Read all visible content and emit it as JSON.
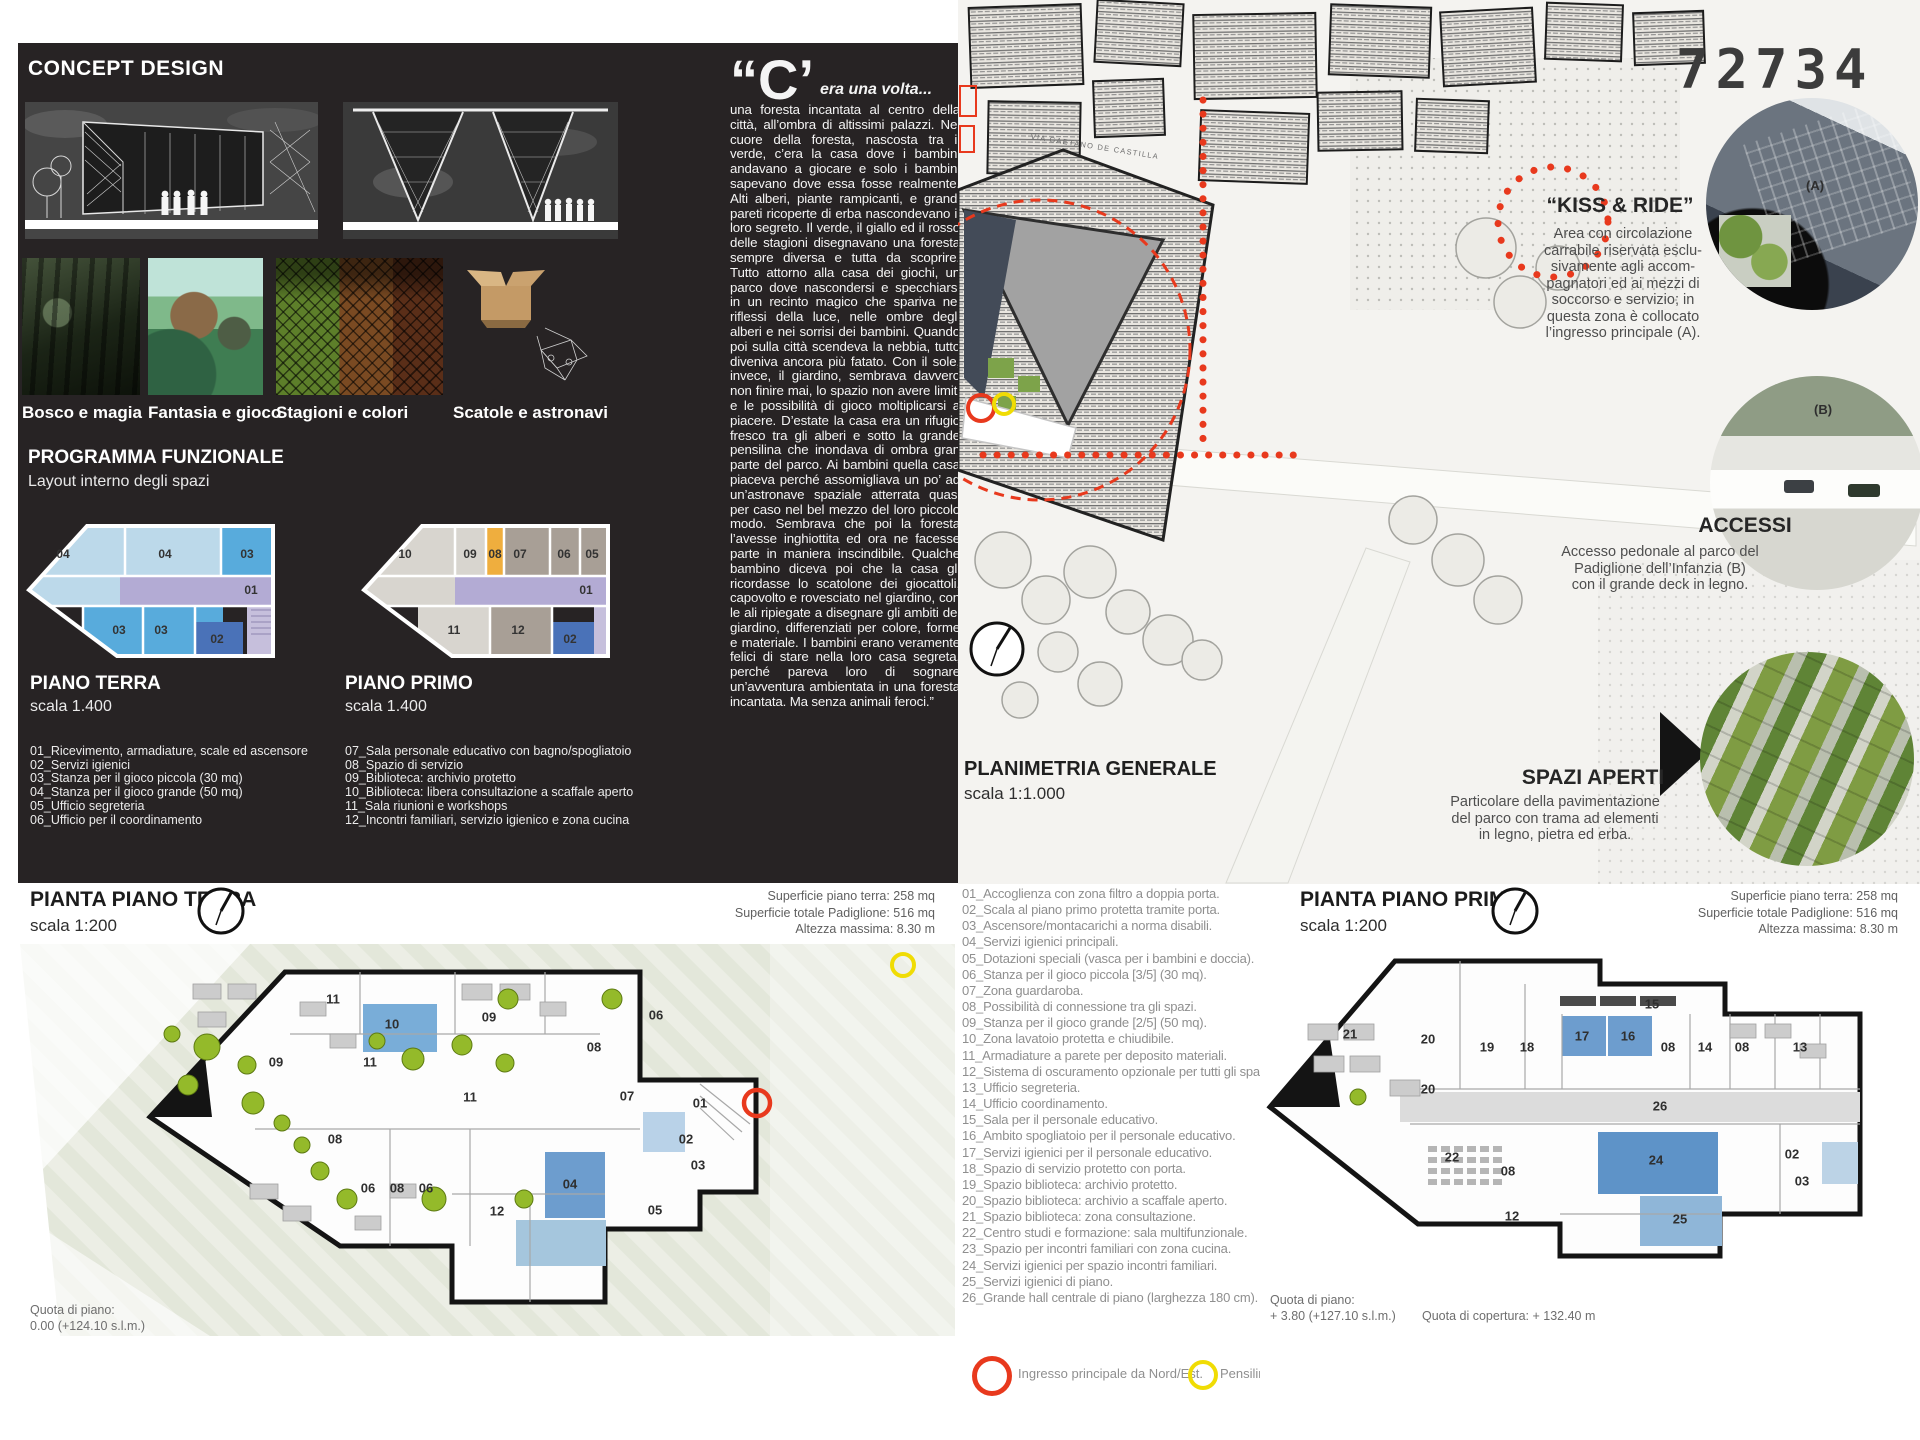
{
  "board_number": "72734",
  "colors": {
    "panel_black": "#272324",
    "accent_red": "#e8391d",
    "accent_yellow": "#f0dc04",
    "tree_green": "#94ba2a",
    "room_blue": "#58abdc",
    "room_dark_blue": "#4a72b8",
    "room_lavender": "#b3abd4",
    "room_orange": "#efae3e"
  },
  "concept": {
    "title": "CONCEPT DESIGN",
    "thumbs": [
      {
        "label": "Bosco e magia"
      },
      {
        "label": "Fantasia e gioco"
      },
      {
        "label": "Stagioni e colori"
      },
      {
        "label": "Scatole e astronavi"
      }
    ],
    "programma_title": "PROGRAMMA FUNZIONALE",
    "programma_subtitle": "Layout interno degli spazi",
    "piano_terra": {
      "title": "PIANO TERRA",
      "scale": "scala 1.400",
      "items": [
        "01_Ricevimento, armadiature, scale ed ascensore",
        "02_Servizi igienici",
        "03_Stanza per il gioco piccola (30 mq)",
        "04_Stanza per il gioco grande (50 mq)",
        "05_Ufficio segreteria",
        "06_Ufficio per il coordinamento"
      ]
    },
    "piano_primo": {
      "title": "PIANO PRIMO",
      "scale": "scala 1.400",
      "items": [
        "07_Sala personale educativo con bagno/spogliatoio",
        "08_Spazio di servizio",
        "09_Biblioteca: archivio protetto",
        "10_Biblioteca: libera consultazione a scaffale aperto",
        "11_Sala riunioni e workshops",
        "12_Incontri familiari, servizio igienico e zona cucina"
      ]
    },
    "mini_terra_rooms": [
      {
        "n": "04",
        "x": 38,
        "y": 36
      },
      {
        "n": "04",
        "x": 140,
        "y": 36
      },
      {
        "n": "03",
        "x": 222,
        "y": 36
      },
      {
        "n": "01",
        "x": 226,
        "y": 72
      },
      {
        "n": "03",
        "x": 94,
        "y": 112
      },
      {
        "n": "03",
        "x": 136,
        "y": 112
      },
      {
        "n": "02",
        "x": 192,
        "y": 121
      }
    ],
    "mini_primo_rooms": [
      {
        "n": "10",
        "x": 45,
        "y": 36
      },
      {
        "n": "09",
        "x": 110,
        "y": 36
      },
      {
        "n": "08",
        "x": 135,
        "y": 36
      },
      {
        "n": "07",
        "x": 160,
        "y": 36
      },
      {
        "n": "06",
        "x": 204,
        "y": 36
      },
      {
        "n": "05",
        "x": 232,
        "y": 36
      },
      {
        "n": "01",
        "x": 226,
        "y": 72
      },
      {
        "n": "11",
        "x": 94,
        "y": 112
      },
      {
        "n": "12",
        "x": 158,
        "y": 112
      },
      {
        "n": "02",
        "x": 210,
        "y": 121
      }
    ]
  },
  "story": {
    "dropcap": "“C’",
    "lead": "era una volta...",
    "body": "una foresta incantata al centro della città, all’ombra di altissimi palazzi. Nel cuore della foresta, nascosta tra il verde, c’era la casa dove i bambini andavano a giocare e solo i bambini sapevano dove essa fosse realmente. Alti alberi, piante rampicanti, e grandi pareti ricoperte di erba nascondevano il loro segreto.  Il verde, il giallo ed il rosso delle stagioni disegnavano una foresta sempre diversa e tutta da scoprire. Tutto attorno alla casa dei giochi, un parco dove nascondersi e specchiarsi in un recinto magico che spariva nei riflessi della luce, nelle ombre degli alberi e nei sorrisi dei bambini. Quando poi sulla città scendeva la nebbia, tutto diveniva ancora più fatato. Con il sole, invece, il giardino, sembrava davvero non finire mai, lo spazio non avere limiti e le possibilità di gioco moltiplicarsi a piacere. D’estate la casa era un rifugio fresco tra gli alberi e sotto la grande pensilina che inondava di ombra gran parte del parco. Ai bambini quella casa piaceva perché assomigliava un po’ ad un’astronave spaziale atterrata quasi per caso nel bel mezzo del loro piccolo modo. Sembrava che poi la foresta l’avesse inghiottita ed ora ne facesse parte in maniera inscindibile. Qualche bambino diceva poi che la casa gli ricordasse lo scatolone dei giocattoli, capovolto e rovesciato nel giardino, con le ali ripiegate a disegnare gli ambiti del giardino, differenziati per colore, forme e materiale. I bambini erano veramente felici di stare nella loro casa segreta, perché pareva loro di sognare un’avventura ambientata in una foresta incantata. Ma senza animali feroci.”"
  },
  "siteplan": {
    "title": "PLANIMETRIA GENERALE",
    "scale": "scala 1:1.000",
    "street_label": "VIA GAETANO DE CASTILLA",
    "label_a": "(A)",
    "label_b": "(B)",
    "kiss_ride": {
      "title": "“KISS & RIDE”",
      "lines": [
        "Area con circolazione",
        "carrabile riservata esclu-",
        "sivamente agli accom-",
        "pagnatori ed ai mezzi di",
        "soccorso e servizio; in",
        "questa zona è collocato",
        "l’ingresso principale (A)."
      ]
    },
    "accessi": {
      "title": "ACCESSI",
      "lines": [
        "Accesso pedonale al parco del",
        "Padiglione dell’Infanzia (B)",
        "con il grande deck in legno."
      ]
    },
    "spazi_aperti": {
      "title": "SPAZI  APERTI",
      "lines": [
        "Particolare della pavimentazione",
        "del parco con trama ad  elementi",
        "in legno, pietra ed erba."
      ]
    }
  },
  "ground_floor": {
    "title": "PIANTA PIANO TERRA",
    "scale": "scala 1:200",
    "stats": [
      "Superficie piano terra: 258 mq",
      "Superficie totale Padiglione: 516 mq",
      "Altezza massima: 8.30 m"
    ],
    "quota_label": "Quota di piano:",
    "quota_value": "0.00 (+124.10 s.l.m.)",
    "rooms": [
      {
        "n": "11",
        "x": 333,
        "y": 115
      },
      {
        "n": "10",
        "x": 392,
        "y": 140
      },
      {
        "n": "09",
        "x": 489,
        "y": 133
      },
      {
        "n": "06",
        "x": 656,
        "y": 131
      },
      {
        "n": "08",
        "x": 594,
        "y": 163
      },
      {
        "n": "09",
        "x": 276,
        "y": 178
      },
      {
        "n": "11",
        "x": 370,
        "y": 178
      },
      {
        "n": "11",
        "x": 470,
        "y": 213
      },
      {
        "n": "07",
        "x": 627,
        "y": 212
      },
      {
        "n": "01",
        "x": 700,
        "y": 219
      },
      {
        "n": "08",
        "x": 335,
        "y": 255
      },
      {
        "n": "02",
        "x": 686,
        "y": 255
      },
      {
        "n": "03",
        "x": 698,
        "y": 281
      },
      {
        "n": "06",
        "x": 368,
        "y": 304
      },
      {
        "n": "08",
        "x": 397,
        "y": 304
      },
      {
        "n": "06",
        "x": 426,
        "y": 304
      },
      {
        "n": "04",
        "x": 570,
        "y": 300
      },
      {
        "n": "12",
        "x": 497,
        "y": 327
      },
      {
        "n": "05",
        "x": 655,
        "y": 326
      }
    ]
  },
  "first_floor": {
    "title": "PIANTA PIANO PRIMO",
    "scale": "scala 1:200",
    "stats": [
      "Superficie piano terra: 258 mq",
      "Superficie totale Padiglione: 516 mq",
      "Altezza massima: 8.30 m"
    ],
    "quota_label": "Quota di piano:",
    "quota_value": "+ 3.80 (+127.10 s.l.m.)",
    "quota_copertura": "Quota di copertura: + 132.40 m",
    "rooms": [
      {
        "n": "15",
        "x": 392,
        "y": 120
      },
      {
        "n": "21",
        "x": 90,
        "y": 150
      },
      {
        "n": "20",
        "x": 168,
        "y": 155
      },
      {
        "n": "19",
        "x": 227,
        "y": 163
      },
      {
        "n": "18",
        "x": 267,
        "y": 163
      },
      {
        "n": "17",
        "x": 322,
        "y": 152
      },
      {
        "n": "16",
        "x": 368,
        "y": 152
      },
      {
        "n": "08",
        "x": 408,
        "y": 163
      },
      {
        "n": "14",
        "x": 445,
        "y": 163
      },
      {
        "n": "08",
        "x": 482,
        "y": 163
      },
      {
        "n": "13",
        "x": 540,
        "y": 163
      },
      {
        "n": "20",
        "x": 168,
        "y": 205
      },
      {
        "n": "26",
        "x": 400,
        "y": 222
      },
      {
        "n": "22",
        "x": 192,
        "y": 273
      },
      {
        "n": "08",
        "x": 248,
        "y": 287
      },
      {
        "n": "24",
        "x": 396,
        "y": 276
      },
      {
        "n": "02",
        "x": 532,
        "y": 270
      },
      {
        "n": "03",
        "x": 542,
        "y": 297
      },
      {
        "n": "25",
        "x": 420,
        "y": 335
      },
      {
        "n": "12",
        "x": 252,
        "y": 332
      }
    ]
  },
  "legend": {
    "items": [
      "01_Accoglienza con zona filtro a doppia porta.",
      "02_Scala al piano primo protetta tramite porta.",
      "03_Ascensore/montacarichi a norma disabili.",
      "04_Servizi igienici principali.",
      "05_Dotazioni speciali (vasca per i bambini e doccia).",
      "06_Stanza per il gioco piccola [3/5] (30 mq).",
      "07_Zona guardaroba.",
      "08_Possibilità di connessione tra gli spazi.",
      "09_Stanza per il gioco grande [2/5] (50 mq).",
      "10_Zona lavatoio protetta e chiudibile.",
      "11_Armadiature a parete per deposito materiali.",
      "12_Sistema di oscuramento opzionale per tutti gli spazi",
      "13_Ufficio segreteria.",
      "14_Ufficio coordinamento.",
      "15_Sala per il personale educativo.",
      "16_Ambito spogliatoio per il personale educativo.",
      "17_Servizi igienici per il personale educativo.",
      "18_Spazio di servizio protetto con porta.",
      "19_Spazio biblioteca: archivio protetto.",
      "20_Spazio biblioteca: archivio a scaffale aperto.",
      "21_Spazio biblioteca: zona consultazione.",
      "22_Centro studi e formazione: sala multifunzionale.",
      "23_Spazio per incontri familiari con zona cucina.",
      "24_Servizi igienici per spazio incontri familiari.",
      "25_Servizi igienici di piano.",
      "26_Grande hall centrale di piano (larghezza 180 cm)."
    ]
  },
  "markers": {
    "ingresso": "Ingresso principale da Nord/Est.",
    "pensilina": "Pensilina."
  }
}
